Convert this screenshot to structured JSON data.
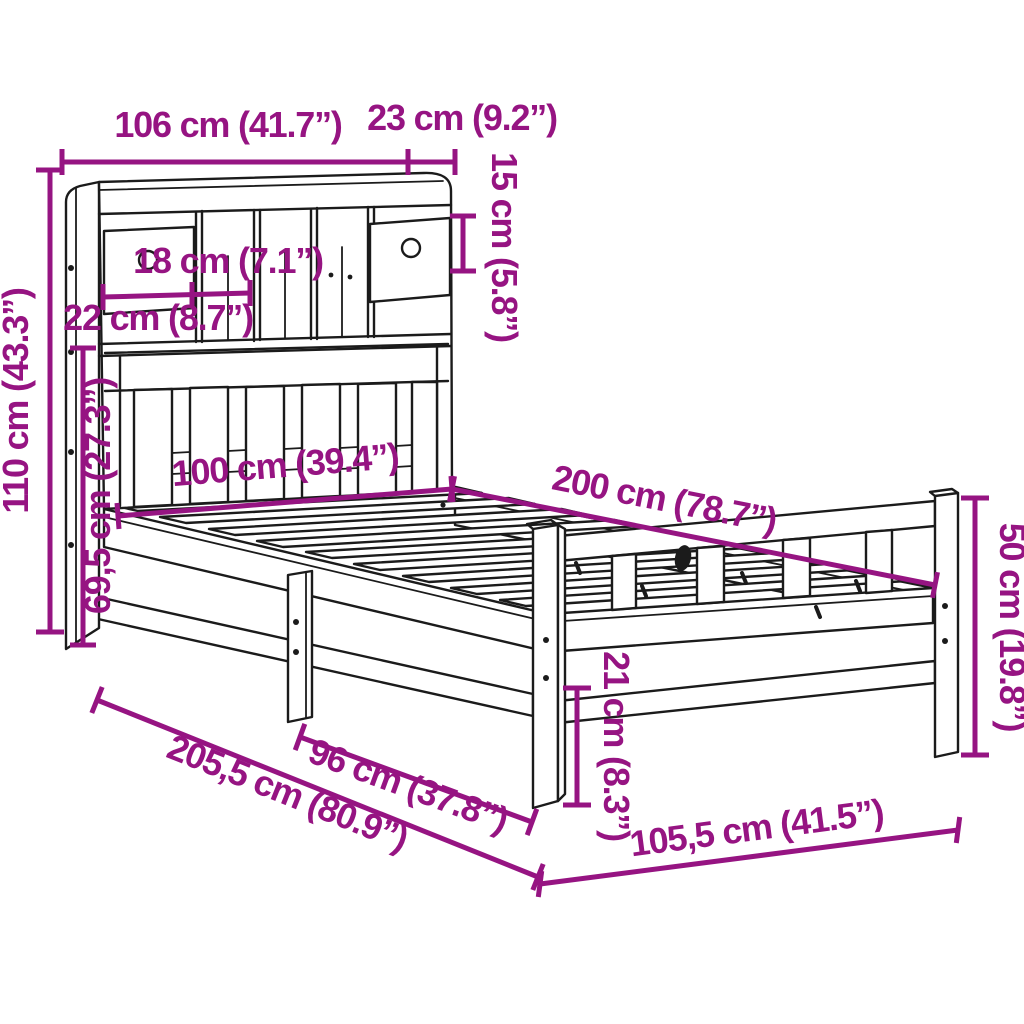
{
  "page": {
    "background": "#ffffff",
    "description": "Dimension line-drawing of a single bed with bookcase headboard, drawers and slatted base"
  },
  "colors": {
    "dimension_annotation": "#961482",
    "drawing_line": "#1b1b1b"
  },
  "dims": {
    "headboard_width": {
      "label": "106 cm (41.7”)"
    },
    "headboard_depth": {
      "label": "23 cm (9.2”)"
    },
    "shelf_height": {
      "label": "15 cm (5.8”)"
    },
    "compartment_width": {
      "label": "18 cm (7.1”)"
    },
    "drawer_width": {
      "label": "22 cm (8.7”)"
    },
    "headboard_height": {
      "label": "110 cm (43.3”)"
    },
    "headboard_lower_height": {
      "label": "69,5 cm (27.3”)"
    },
    "bed_width": {
      "label": "100 cm (39.4”)"
    },
    "bed_length": {
      "label": "200 cm (78.7”)"
    },
    "footboard_height": {
      "label": "50 cm (19.8”)"
    },
    "under_bed_clearance": {
      "label": "21 cm (8.3”)"
    },
    "total_length": {
      "label": "205,5 cm (80.9”)"
    },
    "leg_spacing": {
      "label": "96 cm (37.8”)"
    },
    "foot_end_width": {
      "label": "105,5 cm (41.5”)"
    }
  }
}
